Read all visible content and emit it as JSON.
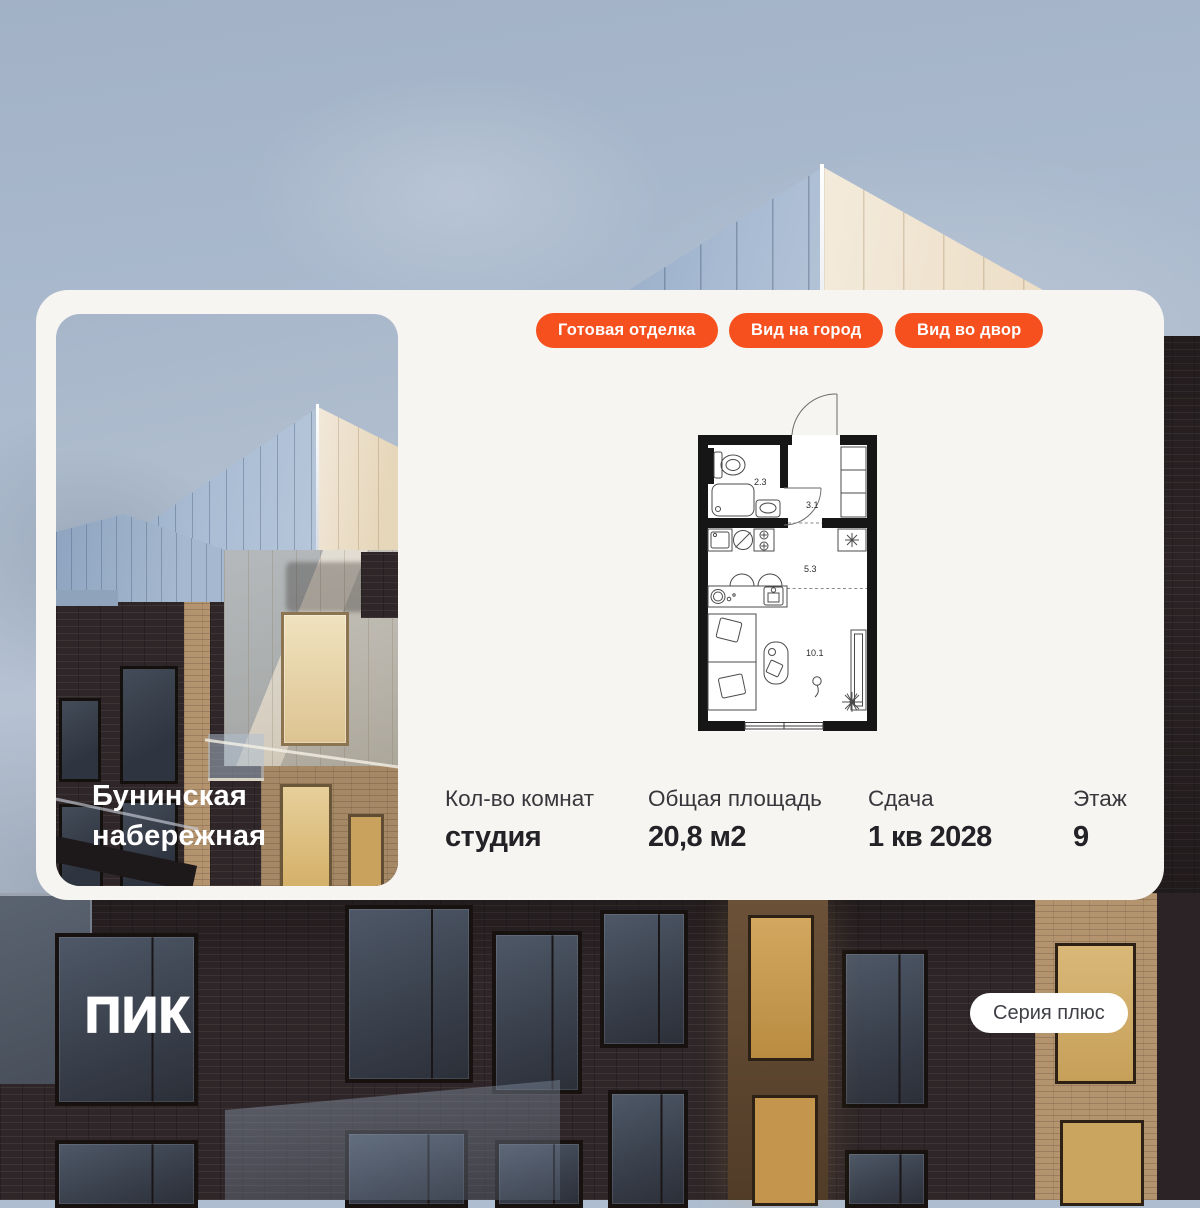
{
  "colors": {
    "accent_orange": "#F5501E",
    "card_background": "#F7F5F1",
    "plan_walls": "#161616",
    "title_text": "#FFFFFF"
  },
  "project": {
    "name_line1": "Бунинская",
    "name_line2": "набережная"
  },
  "badges": [
    {
      "label": "Готовая отделка"
    },
    {
      "label": "Вид на город"
    },
    {
      "label": "Вид во двор"
    }
  ],
  "floorplan": {
    "areas": [
      "2.3",
      "3.1",
      "5.3",
      "10.1"
    ]
  },
  "stats": [
    {
      "label": "Кол-во комнат",
      "value": "студия"
    },
    {
      "label": "Общая площадь",
      "value": "20,8 м2"
    },
    {
      "label": "Сдача",
      "value": "1 кв 2028"
    },
    {
      "label": "Этаж",
      "value": "9"
    }
  ],
  "footer": {
    "logo_text": "ПИК",
    "series_button_label": "Серия плюс"
  }
}
